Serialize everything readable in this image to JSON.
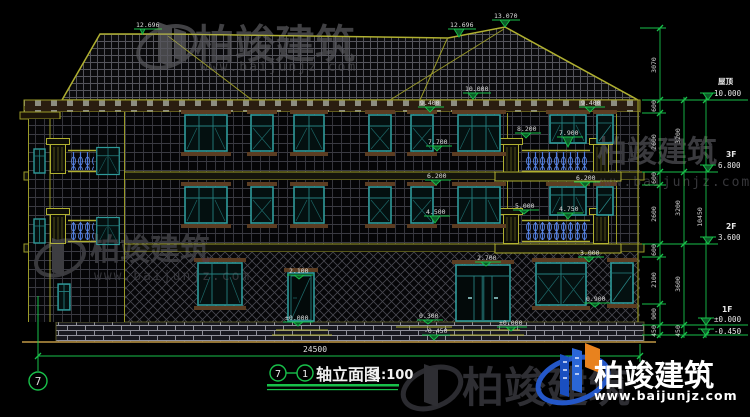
{
  "drawing": {
    "title": "轴立面图",
    "scale": "1:100",
    "axis_bubble_start": "7",
    "axis_bubble_end": "1",
    "axis_bubble_bottom_left": "7"
  },
  "dimensions": {
    "total_width": "24500",
    "total_height": "10450",
    "chain_detail": [
      "3070",
      "600",
      "2600",
      "600",
      "2600",
      "600",
      "2100",
      "900",
      "450"
    ],
    "chain_floor": [
      "3200",
      "3200",
      "3600",
      "450"
    ]
  },
  "levels": [
    {
      "label": "屋顶",
      "value": "10.000"
    },
    {
      "label": "3F",
      "value": "6.800"
    },
    {
      "label": "2F",
      "value": "3.600"
    },
    {
      "label": "1F",
      "value": "±0.000"
    },
    {
      "label": "",
      "value": "-0.450"
    }
  ],
  "markers": [
    "12.696",
    "12.696",
    "13.070",
    "10.000",
    "9.400",
    "9.400",
    "7.700",
    "6.200",
    "4.500",
    "8.200",
    "7.900",
    "6.200",
    "5.000",
    "4.750",
    "3.000",
    "2.700",
    "2.100",
    "0.900",
    "±0.000",
    "±0.000",
    "0.300",
    "-0.450"
  ],
  "watermark": {
    "brand": "柏竣建筑",
    "url": "www.baijunjz.com"
  },
  "logo": {
    "brand": "柏竣建筑",
    "url": "www.baijunjz.com"
  },
  "colors": {
    "line_yellow": "#b0b030",
    "line_green": "#18c04a",
    "window_teal": "#2f9b9b",
    "baluster_blue": "#4a7ae0",
    "ground_tan": "#a5823c"
  }
}
